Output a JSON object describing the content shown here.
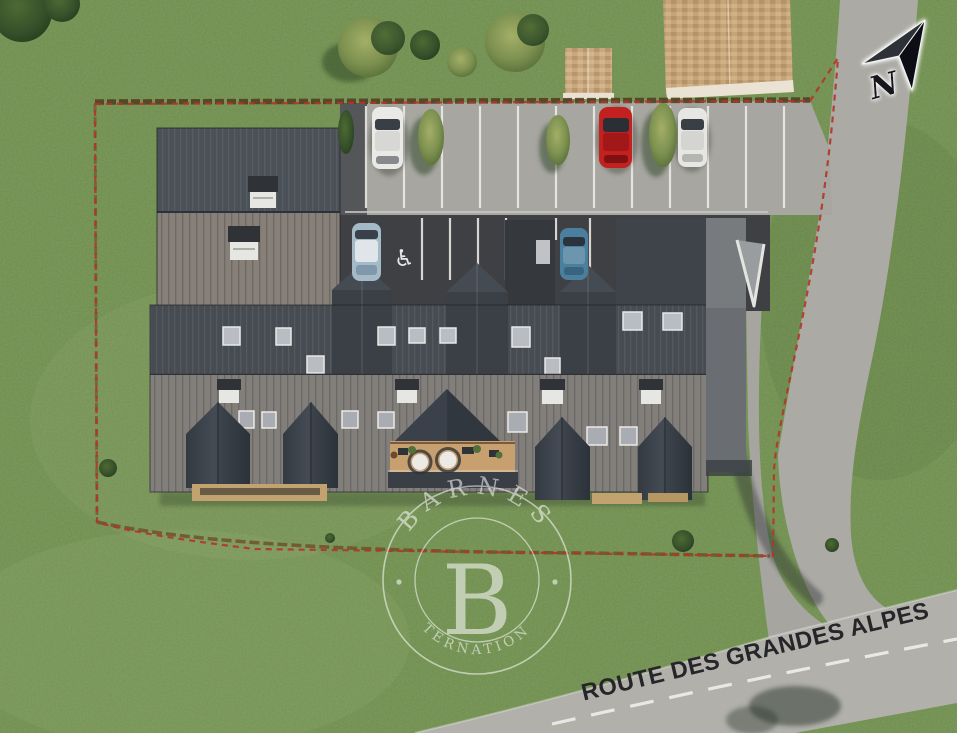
{
  "meta": {
    "scene": "aerial-3d-site-plan-render",
    "description": "Top-down architectural rendering of a chalet residence with parking, private driveway and road"
  },
  "watermark": {
    "brand": "BARNES",
    "monogram": "B",
    "subtitle": "INTERNATIONAL"
  },
  "road_label": {
    "text": "ROUTE DES GRANDES ALPES"
  },
  "compass": {
    "label": "N"
  },
  "parking": {
    "accessible_symbol": "♿",
    "accessible_spaces": 2,
    "vehicles": [
      {
        "color_name": "white",
        "hex": "#e9e9e6",
        "row": "top"
      },
      {
        "color_name": "red",
        "hex": "#c32020",
        "row": "top"
      },
      {
        "color_name": "white",
        "hex": "#e6e6e3",
        "row": "top"
      },
      {
        "color_name": "light-blue",
        "hex": "#a5bac7",
        "row": "covered"
      },
      {
        "color_name": "blue",
        "hex": "#4a7f9e",
        "row": "covered"
      }
    ]
  },
  "site": {
    "boundary_style": "red-dashed",
    "boundary_color": "#b23527",
    "grass_color": "#6f8d4f",
    "road_color": "#abaaa5",
    "roof_dark_color": "#474c53",
    "roof_light_color": "#827f7b",
    "wood_roof_color": "#c6a478",
    "deck_color": "#c89f6f"
  }
}
